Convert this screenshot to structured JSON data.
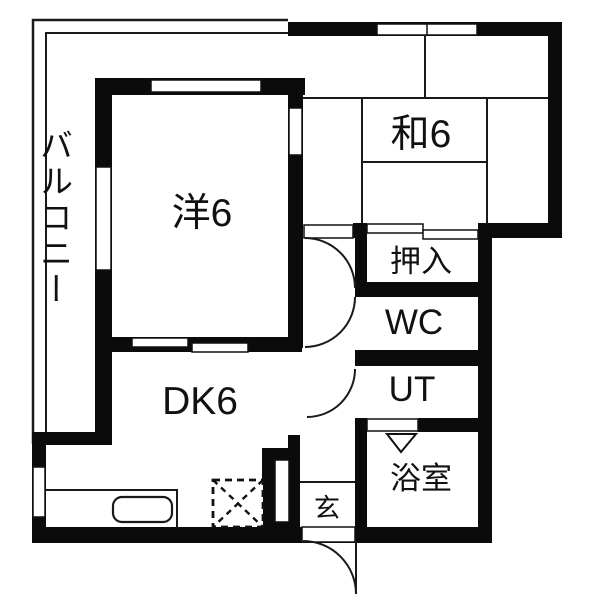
{
  "plan_title": "1DK apartment floor plan",
  "rooms": {
    "balcony": {
      "label": "バルコニー"
    },
    "western_room": {
      "label": "洋6"
    },
    "japanese_room": {
      "label": "和6"
    },
    "dining_kitchen": {
      "label": "DK6"
    },
    "closet": {
      "label": "押入"
    },
    "toilet": {
      "label": "WC"
    },
    "utility": {
      "label": "UT"
    },
    "bathroom": {
      "label": "浴室"
    },
    "entrance": {
      "label": "玄"
    }
  },
  "colors": {
    "wall": "#0b0b0b",
    "line": "#1a1a1a",
    "background": "#ffffff"
  }
}
